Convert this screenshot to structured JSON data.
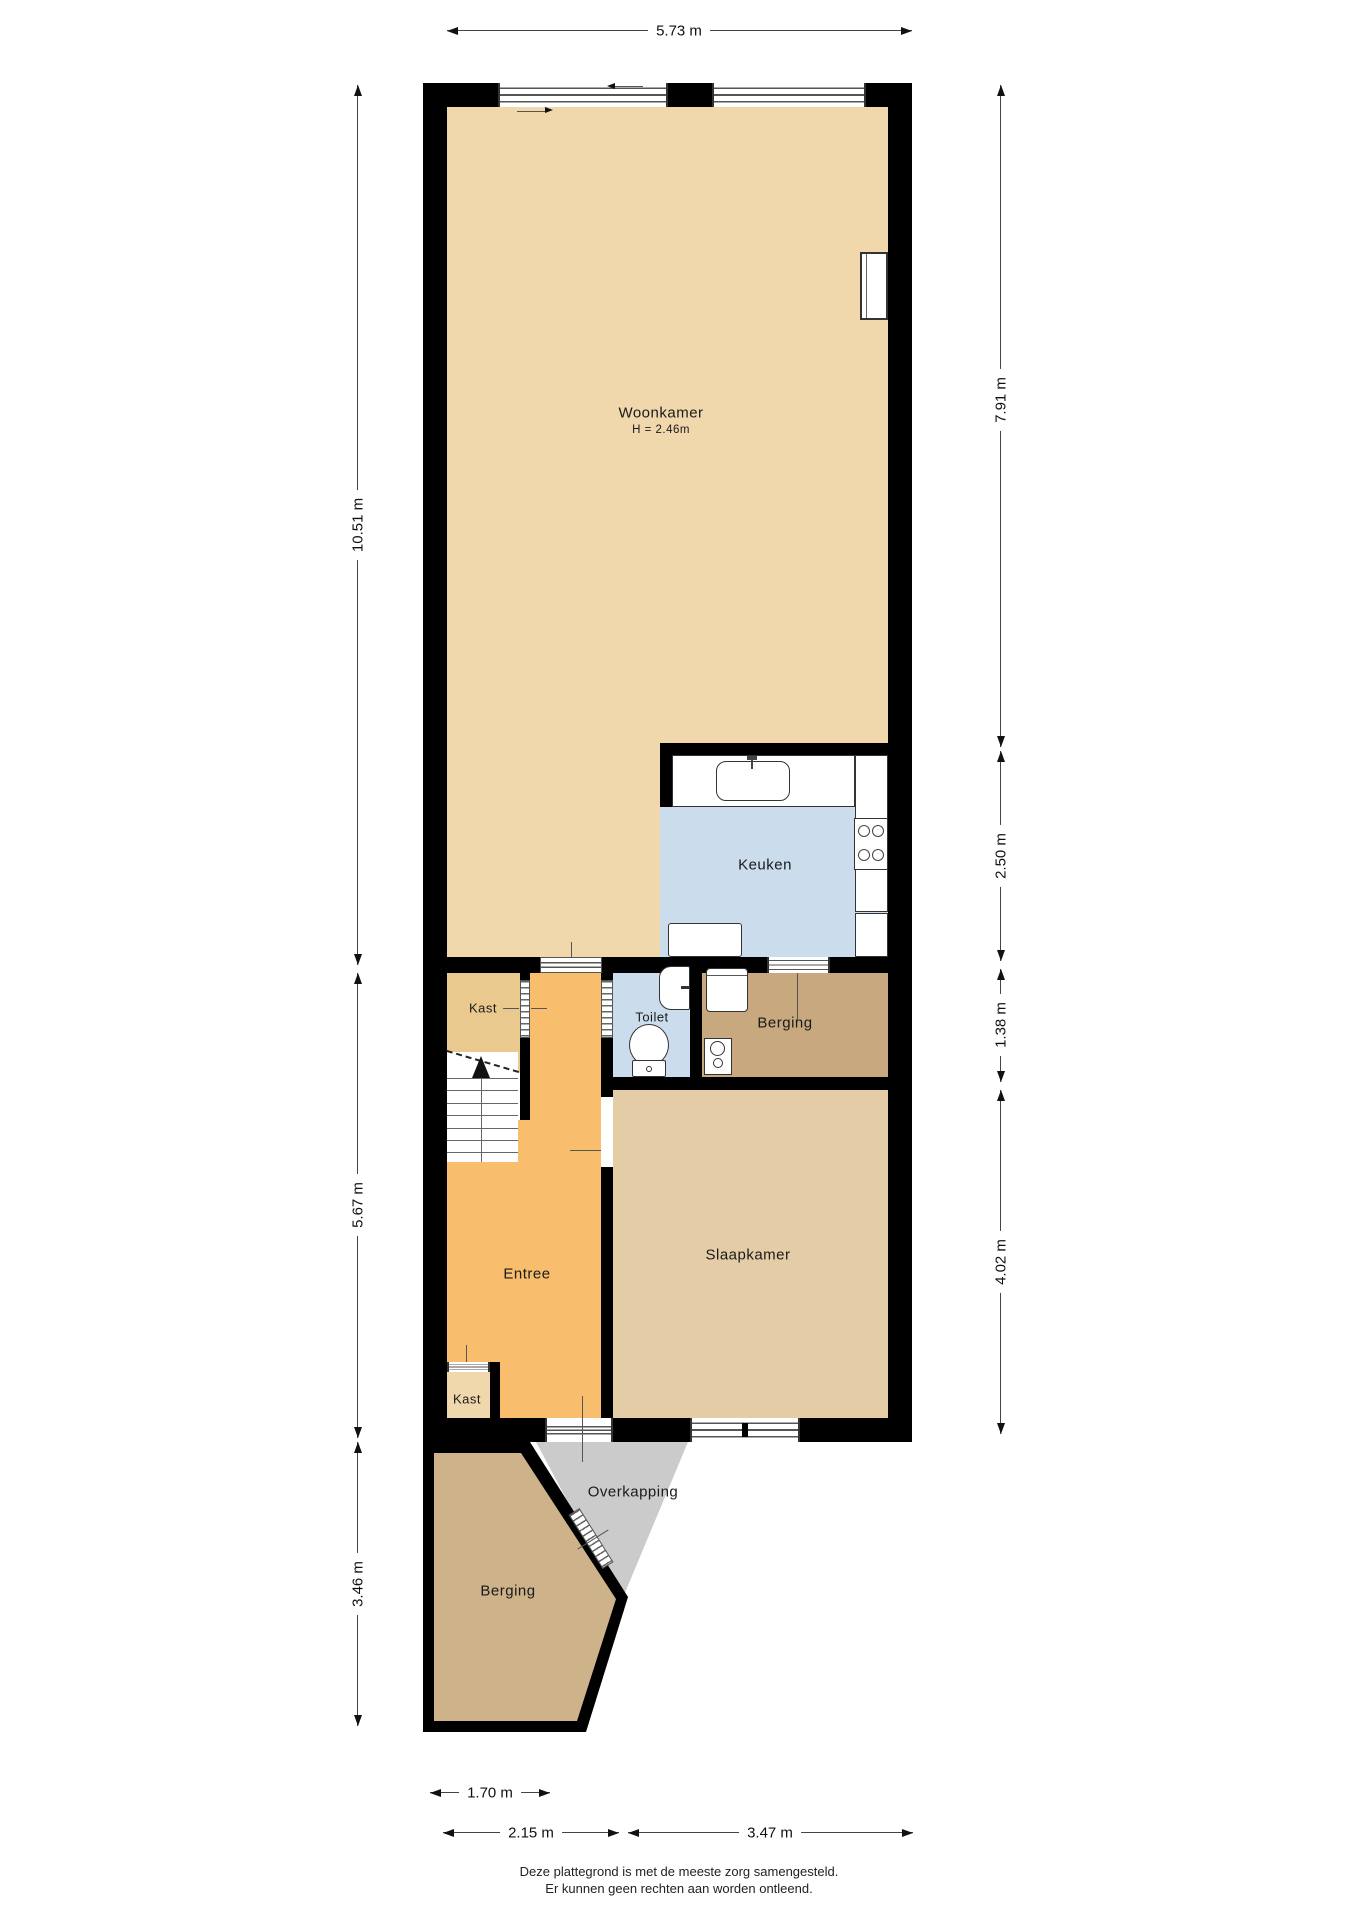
{
  "rooms": {
    "woonkamer": {
      "label": "Woonkamer",
      "height_label": "H = 2.46m"
    },
    "keuken": {
      "label": "Keuken"
    },
    "kast_upper": {
      "label": "Kast"
    },
    "toilet": {
      "label": "Toilet"
    },
    "berging_inner": {
      "label": "Berging"
    },
    "entree": {
      "label": "Entree"
    },
    "slaapkamer": {
      "label": "Slaapkamer"
    },
    "kast_lower": {
      "label": "Kast"
    },
    "overkapping": {
      "label": "Overkapping"
    },
    "berging_outer": {
      "label": "Berging"
    }
  },
  "dimensions": {
    "top": "5.73 m",
    "left": [
      "10.51 m",
      "5.67 m",
      "3.46 m"
    ],
    "right": [
      "7.91 m",
      "2.50 m",
      "1.38 m",
      "4.02 m"
    ],
    "bottom": [
      "1.70 m",
      "2.15 m",
      "3.47 m"
    ]
  },
  "footer": {
    "line1": "Deze plattegrond is met de meeste zorg samengesteld.",
    "line2": "Er kunnen geen rechten aan worden ontleend."
  },
  "colors": {
    "wall": "#000000",
    "floor_main": "#F0D8AC",
    "floor_kast": "#E9C98E",
    "floor_entree": "#F8BE6E",
    "floor_kitchen": "#CBDDED",
    "floor_berging": "#C8A87E",
    "floor_slaapkamer": "#E4CDA6",
    "floor_berging_buiten": "#CDB28A",
    "overkapping_grey": "#CBCBCB"
  }
}
